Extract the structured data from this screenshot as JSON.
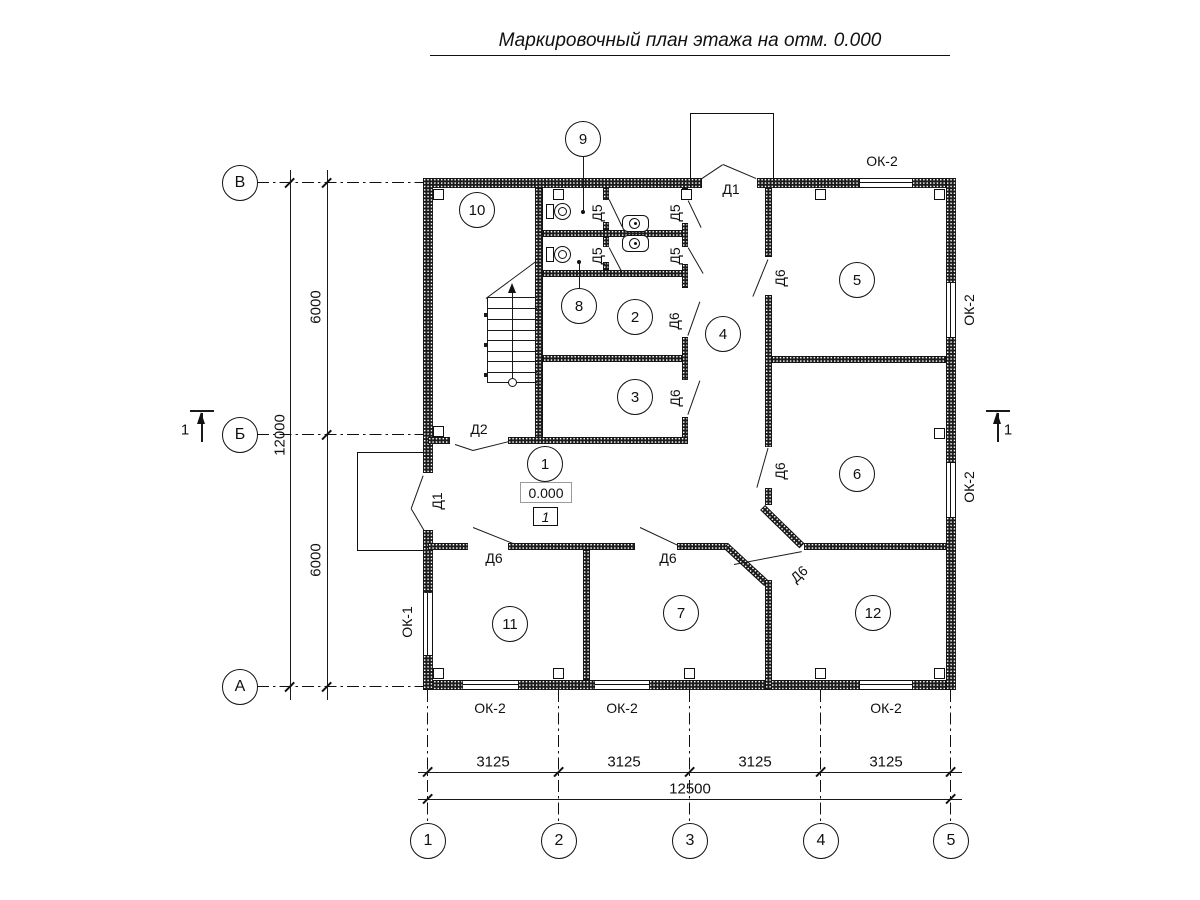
{
  "title": "Маркировочный план этажа на отм. 0.000",
  "labels": {
    "d1": "Д1",
    "d2": "Д2",
    "d5": "Д5",
    "d6": "Д6",
    "ok1": "ОК-1",
    "ok2": "ОК-2"
  },
  "rooms": [
    "1",
    "2",
    "3",
    "4",
    "5",
    "6",
    "7",
    "8",
    "9",
    "10",
    "11",
    "12"
  ],
  "axes": {
    "rows": [
      "В",
      "Б",
      "А"
    ],
    "cols": [
      "1",
      "2",
      "3",
      "4",
      "5"
    ]
  },
  "dims": {
    "left_segments": [
      "6000",
      "6000"
    ],
    "left_total": "12000",
    "bottom_segments": [
      "3125",
      "3125",
      "3125",
      "3125"
    ],
    "bottom_total": "12500"
  },
  "elevation": {
    "value": "0.000",
    "floor_type": "1"
  },
  "section": {
    "label": "1"
  }
}
